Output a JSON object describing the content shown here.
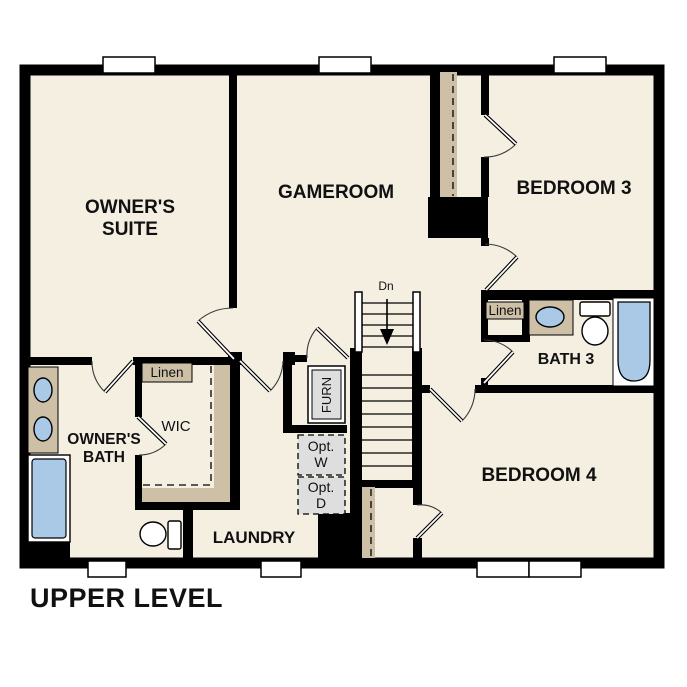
{
  "plan_title": "UPPER LEVEL",
  "colors": {
    "floor": "#f5efe2",
    "wall": "#000000",
    "counter_tan": "#cec0a7",
    "fixture_blue": "#a9c9e7",
    "appliance_gray": "#dedede",
    "window_white": "#ffffff"
  },
  "rooms": {
    "owners_suite": {
      "label_line1": "OWNER'S",
      "label_line2": "SUITE"
    },
    "gameroom": {
      "label": "GAMEROOM"
    },
    "bedroom3": {
      "label": "BEDROOM 3"
    },
    "bath3": {
      "label": "BATH 3"
    },
    "bedroom4": {
      "label": "BEDROOM 4"
    },
    "owners_bath": {
      "label_line1": "OWNER'S",
      "label_line2": "BATH"
    },
    "wic": {
      "label": "WIC"
    },
    "laundry": {
      "label": "LAUNDRY"
    }
  },
  "closets": {
    "linen_wic": "Linen",
    "linen_bath3": "Linen"
  },
  "equipment": {
    "furnace": "FURN",
    "opt_washer_line1": "Opt.",
    "opt_washer_line2": "W",
    "opt_dryer_line1": "Opt.",
    "opt_dryer_line2": "D"
  },
  "stairs": {
    "direction_label": "Dn"
  }
}
